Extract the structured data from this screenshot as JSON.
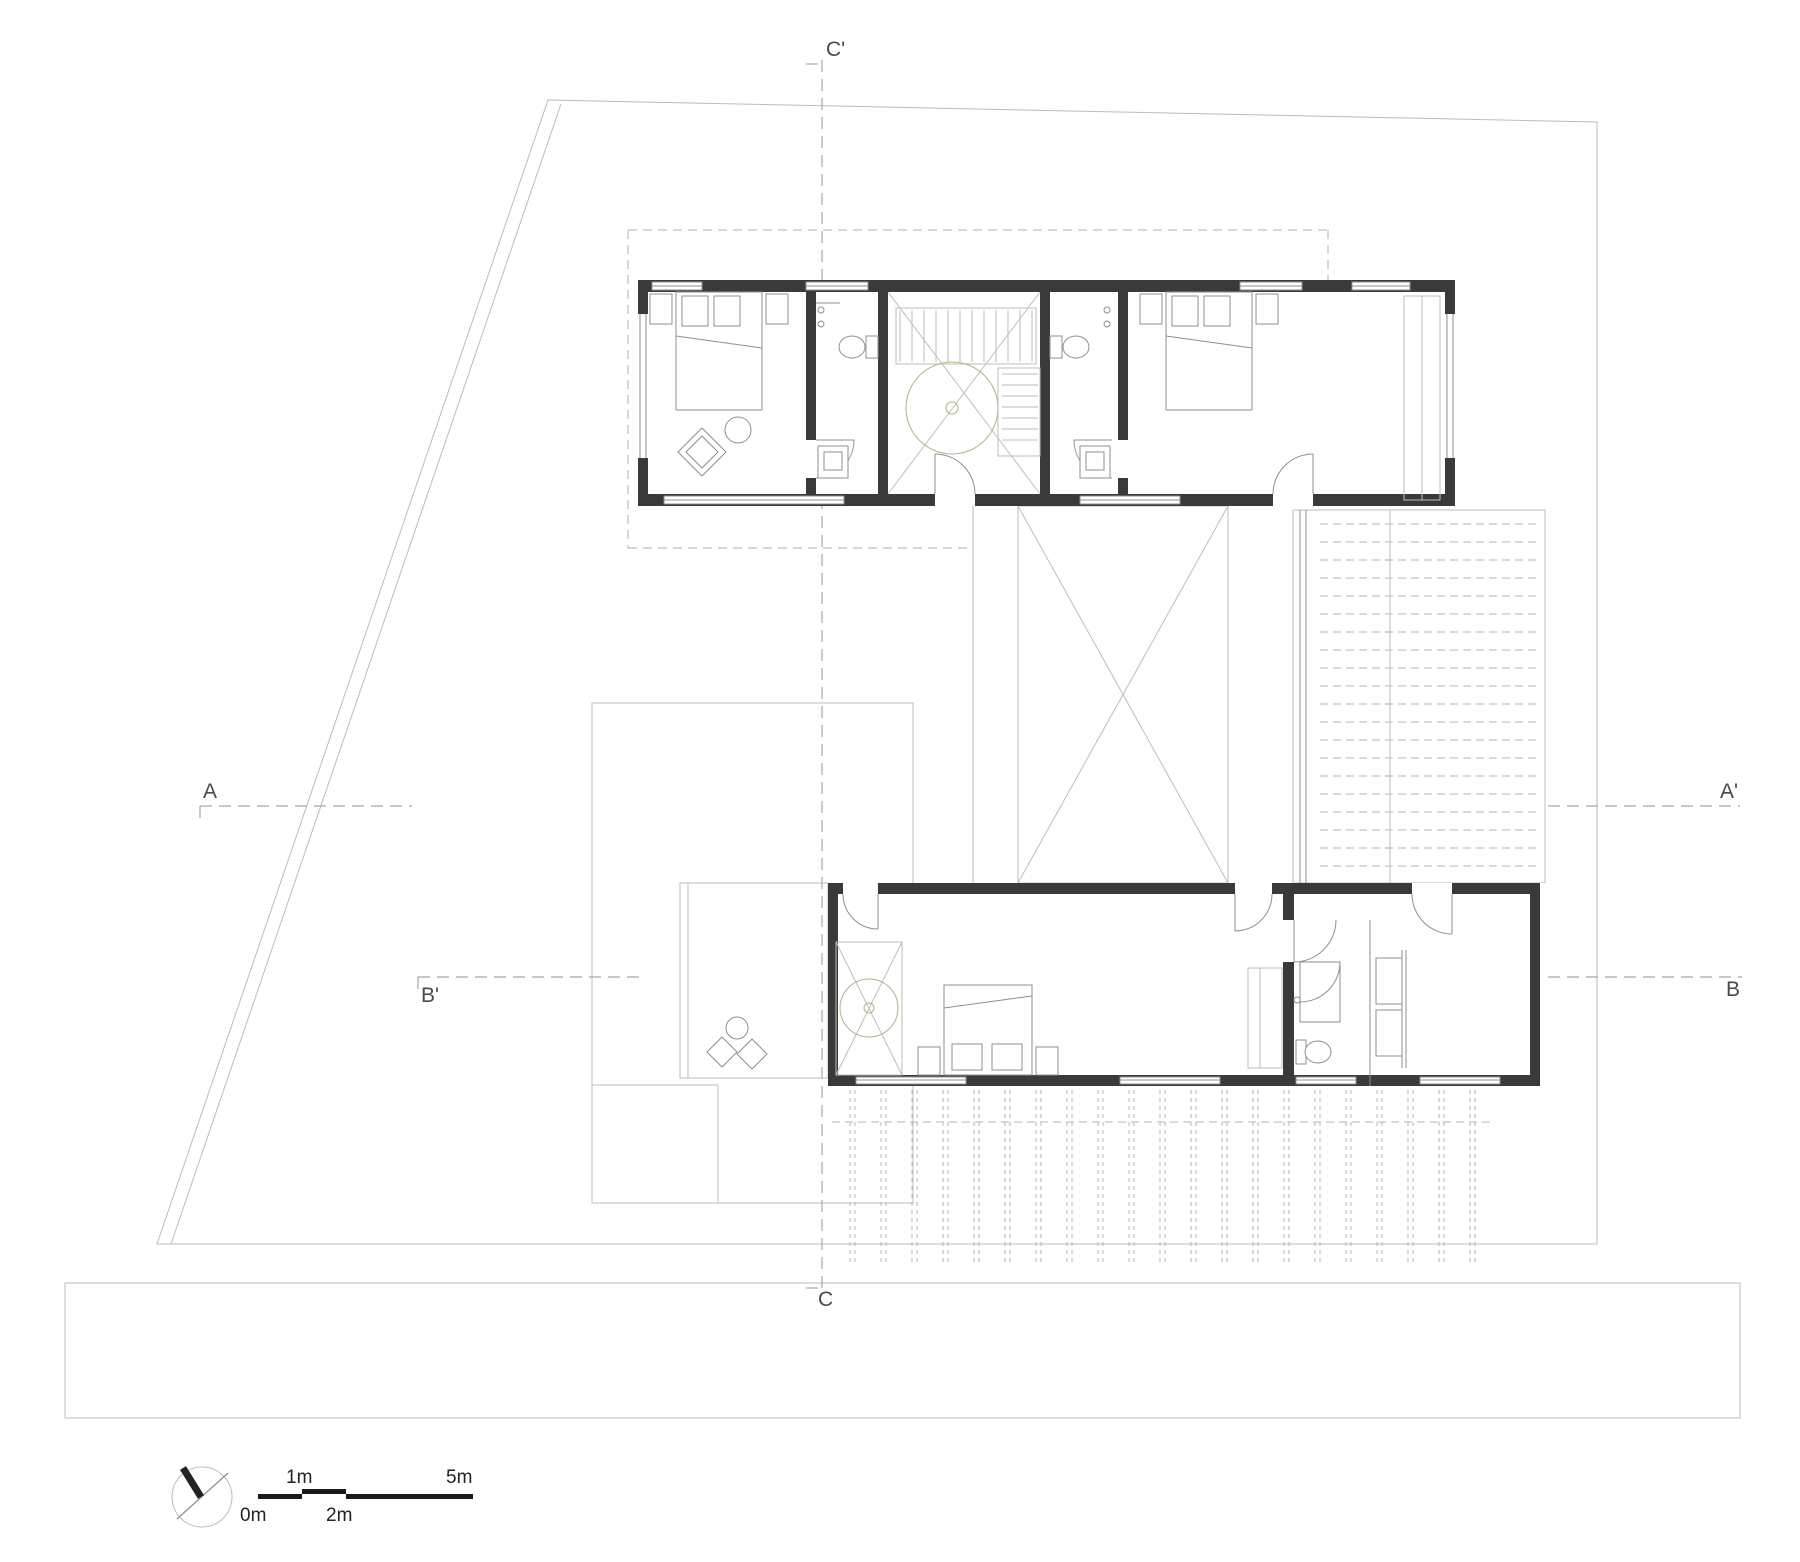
{
  "drawing_colors": {
    "wall": "#3a3a3a",
    "light_line": "#bdbdbd",
    "medium_line": "#8f8f8f",
    "dashed_line": "#a6a6a6",
    "skylight_accent": "#b6b189",
    "label_text": "#4a4a4a",
    "scalebar_ink": "#1a1a1a"
  },
  "section_labels": {
    "c_prime": "C'",
    "c": "C",
    "a": "A",
    "a_prime": "A'",
    "b_prime": "B'",
    "b": "B"
  },
  "scale_bar": {
    "label_0m": "0m",
    "label_1m": "1m",
    "label_2m": "2m",
    "label_5m": "5m"
  },
  "icons": {
    "north": "north-arrow"
  }
}
